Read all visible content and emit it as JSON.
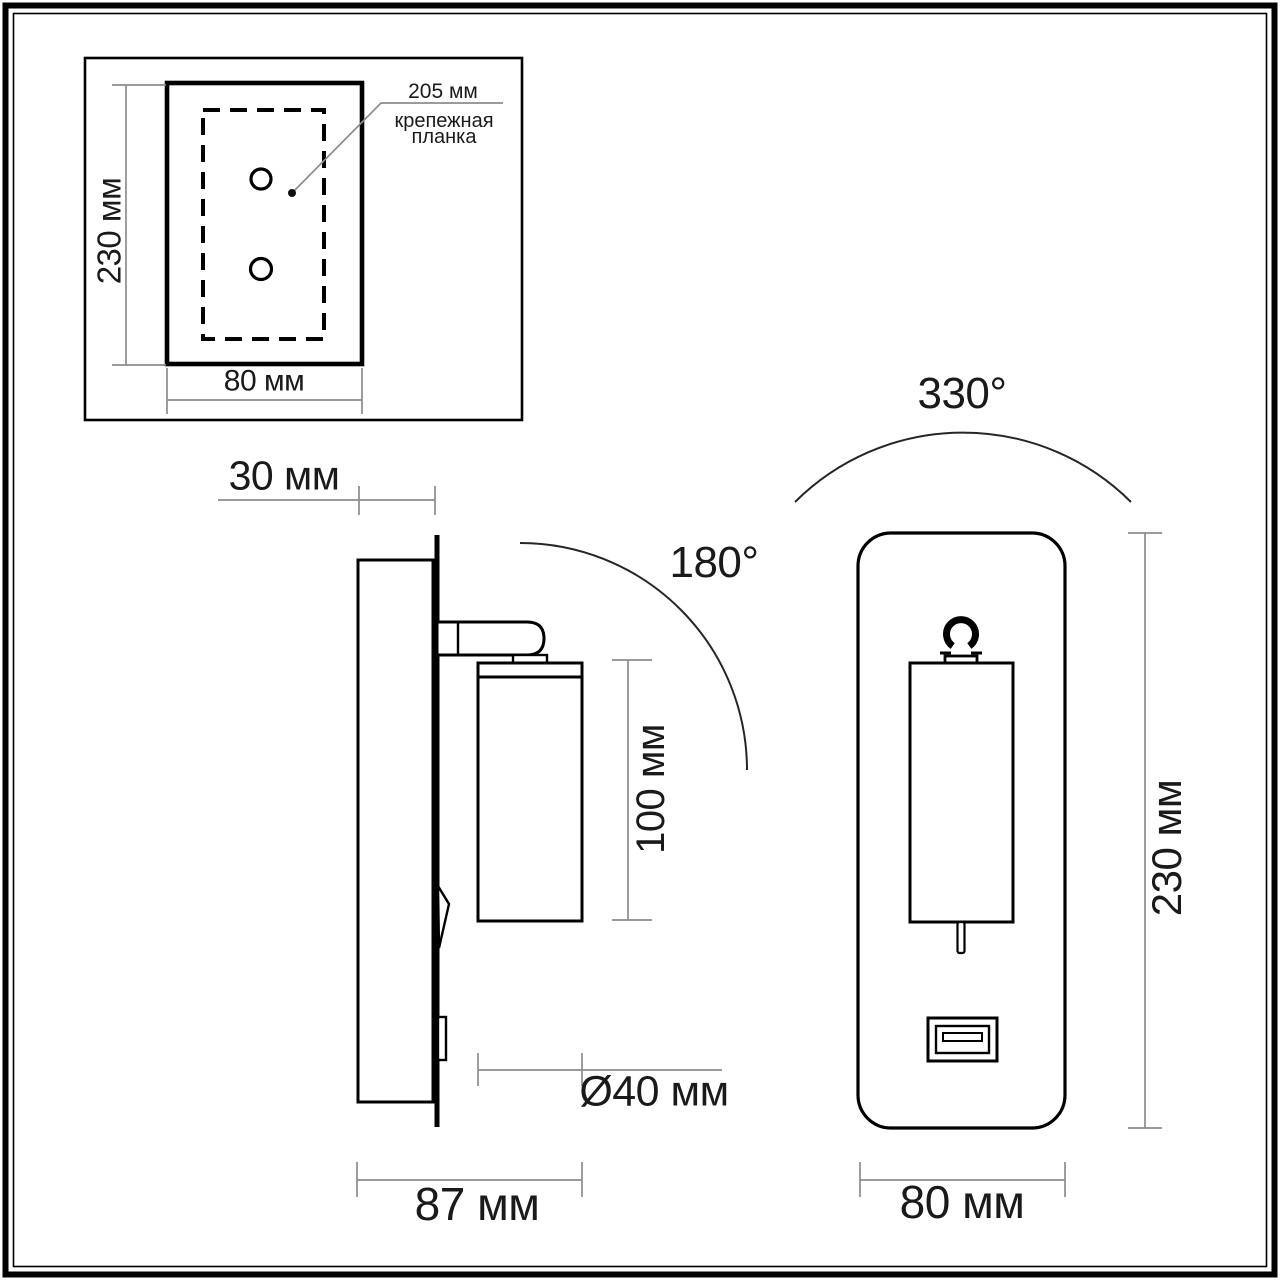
{
  "drawing": {
    "type": "wall-lamp technical dimension drawing",
    "units": "мм"
  },
  "colors": {
    "ink": "#000000",
    "dim_line": "#8c8c8c",
    "text": "#1a1a1a",
    "background": "#ffffff"
  },
  "inset_view": {
    "height_label": "230 мм",
    "width_label": "80 мм",
    "callout_value": "205 мм",
    "callout_name_line1": "крепежная",
    "callout_name_line2": "планка"
  },
  "side_view": {
    "depth_label": "30 мм",
    "swivel_angle_label": "180°",
    "lamp_length_label": "100 мм",
    "lamp_diameter_label": "Ø40 мм",
    "total_depth_label": "87 мм"
  },
  "front_view": {
    "rotation_angle_label": "330°",
    "height_label": "230 мм",
    "width_label": "80 мм"
  }
}
